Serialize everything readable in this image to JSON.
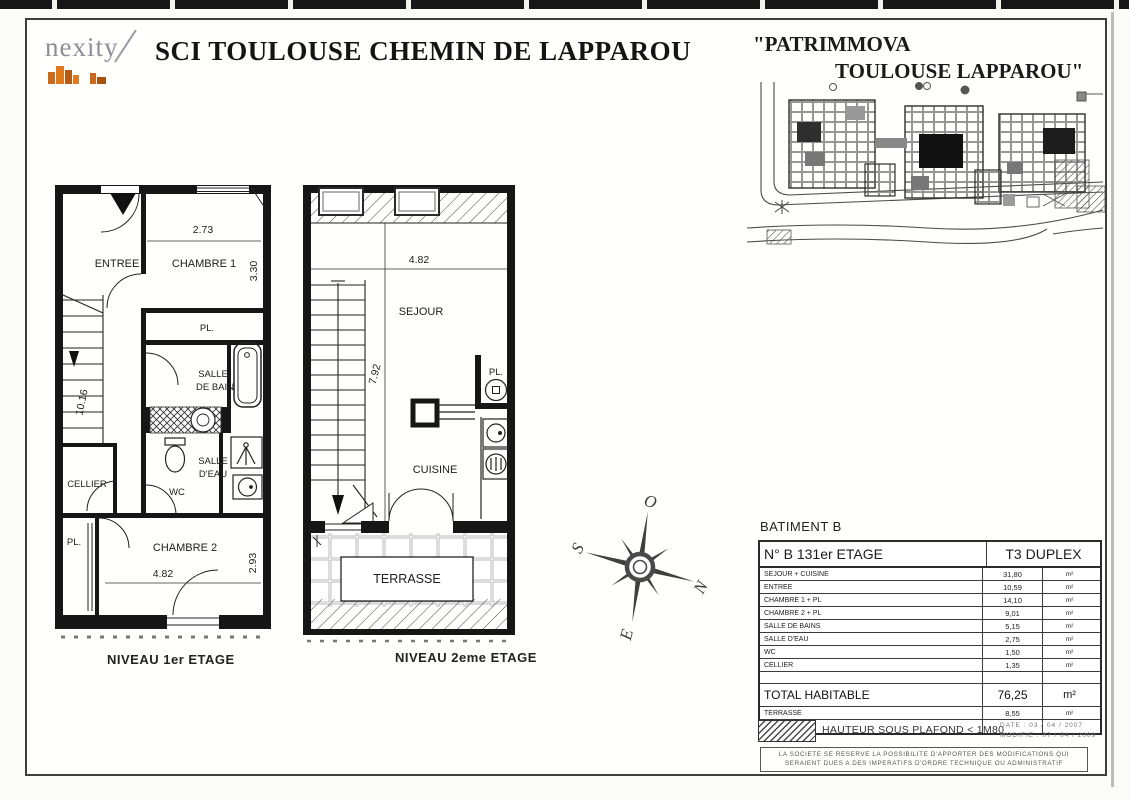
{
  "header": {
    "logo": "nexity",
    "title": "SCI TOULOUSE CHEMIN DE LAPPAROU",
    "project_line1": "\"PATRIMMOVA",
    "project_line2": "TOULOUSE LAPPAROU\""
  },
  "plans": {
    "level1": {
      "caption": "NIVEAU 1er ETAGE",
      "rooms": {
        "entree": "ENTREE",
        "chambre1": "CHAMBRE 1",
        "pl_top": "PL.",
        "salle_de_bain_1": "SALLE",
        "salle_de_bain_2": "DE BAIN",
        "wc": "WC",
        "salle_deau_1": "SALLE",
        "salle_deau_2": "D'EAU",
        "cellier": "CELLIER",
        "pl_bottom": "PL.",
        "chambre2": "CHAMBRE 2"
      },
      "dimensions": {
        "chambre1_width": "2.73",
        "chambre1_height": "3.30",
        "stairwell_height": "10.16",
        "chambre2_width": "4.82",
        "chambre2_height": "2.93"
      }
    },
    "level2": {
      "caption": "NIVEAU 2eme ETAGE",
      "rooms": {
        "sejour": "SEJOUR",
        "cuisine": "CUISINE",
        "pl": "PL.",
        "terrasse": "TERRASSE"
      },
      "dimensions": {
        "sejour_width": "4.82",
        "sejour_height": "7.92"
      }
    }
  },
  "compass": {
    "north": "N",
    "south": "S",
    "east": "E",
    "west": "O"
  },
  "summary": {
    "building": "BATIMENT B",
    "unit_number": "N° B 13",
    "floor": "1er ETAGE",
    "unit_type": "T3 DUPLEX",
    "rows": [
      {
        "label": "SEJOUR + CUISINE",
        "value": "31,80",
        "unit": "m²"
      },
      {
        "label": "ENTREE",
        "value": "10,59",
        "unit": "m²"
      },
      {
        "label": "CHAMBRE 1 + PL",
        "value": "14,10",
        "unit": "m²"
      },
      {
        "label": "CHAMBRE 2 + PL",
        "value": "9,01",
        "unit": "m²"
      },
      {
        "label": "SALLE DE BAINS",
        "value": "5,15",
        "unit": "m²"
      },
      {
        "label": "SALLE D'EAU",
        "value": "2,75",
        "unit": "m²"
      },
      {
        "label": "WC",
        "value": "1,50",
        "unit": "m²"
      },
      {
        "label": "CELLIER",
        "value": "1,35",
        "unit": "m²"
      }
    ],
    "total": {
      "label": "TOTAL HABITABLE",
      "value": "76,25",
      "unit": "m²"
    },
    "terrasse": {
      "label": "TERRASSE",
      "value": "8,55",
      "unit": "m²"
    }
  },
  "footer": {
    "legend": "HAUTEUR SOUS PLAFOND < 1M80",
    "date": "DATE : 03 / 04 / 2007",
    "modified": "MODIFIE : 07 / 04 / 2009",
    "disclaimer1": "LA SOCIETE SE RESERVE LA POSSIBILITE D'APPORTER DES MODIFICATIONS QUI",
    "disclaimer2": "SERAIENT DUES A DES IMPERATIFS D'ORDRE TECHNIQUE OU ADMINISTRATIF"
  }
}
